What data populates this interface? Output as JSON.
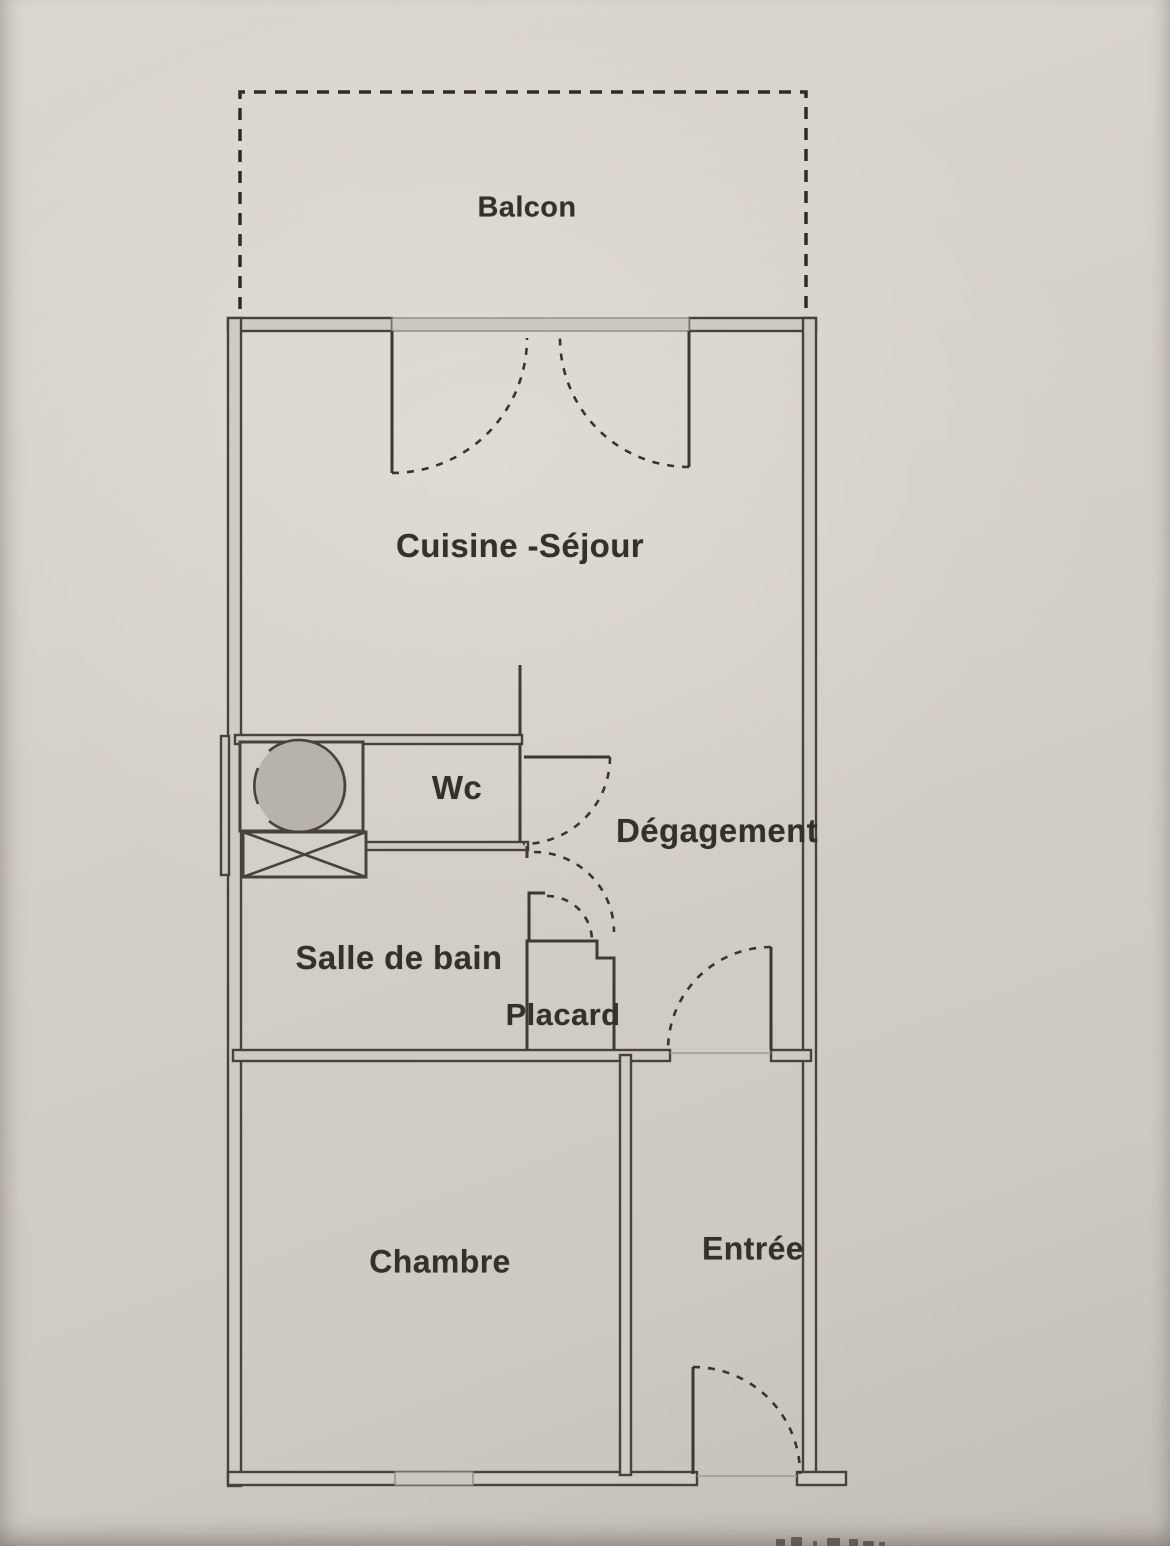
{
  "document": {
    "kind_label": "apartment floor plan (scanned)"
  },
  "rooms": {
    "balcon": {
      "label": "Balcon"
    },
    "cuisine_sejour": {
      "label": "Cuisine -Séjour"
    },
    "wc": {
      "label": "Wc"
    },
    "degagement": {
      "label": "Dégagement"
    },
    "salle_de_bain": {
      "label": "Salle de bain"
    },
    "placard": {
      "label": "Placard"
    },
    "chambre": {
      "label": "Chambre"
    },
    "entree": {
      "label": "Entrée"
    }
  },
  "icons": {
    "washbasin": "washbasin-circle-icon",
    "water_heater": "crossed-box-icon"
  },
  "colors": {
    "paper": "#d7d3cc",
    "wall_line": "#46423c",
    "wall_fill": "#cfcbc4",
    "dash_line": "#38342e",
    "fixture_gray": "#b7b2ab",
    "soft_line": "#9d9991",
    "text": "#34302a"
  }
}
